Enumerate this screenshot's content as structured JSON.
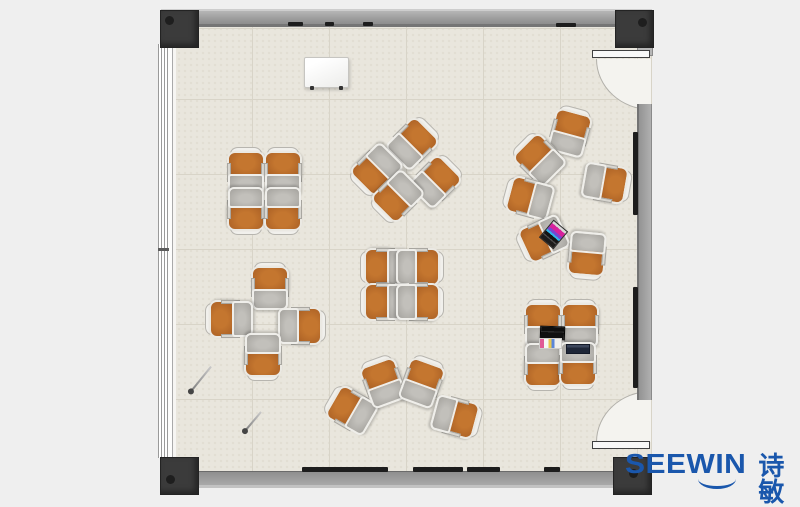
{
  "logo": {
    "brand_en": "SEEWIN",
    "brand_cn": "诗敏",
    "color": "#1a57ac"
  },
  "palette": {
    "page_bg": "#efefef",
    "floor": "#e9e6dd",
    "tile_line": "#d8d4c8",
    "wall": "#9c9c9c",
    "wall_edge": "#757575",
    "post": "#3b3b3b",
    "chair_seat": "#c4762f",
    "chair_seat_edge": "#9d5a22",
    "chair_outline": "#ebe9e3",
    "desk_top": "#b1afaa",
    "desk_outline": "#efeeea",
    "door_sweep": "#f4f3ef",
    "board_strip": "#1d1d1d",
    "window_white": "#fdfdfc",
    "logo_blue": "#1a57ac"
  },
  "room": {
    "wall_boards": [
      {
        "x": 288,
        "y": 22,
        "w": 15,
        "h": 4
      },
      {
        "x": 325,
        "y": 22,
        "w": 9,
        "h": 4
      },
      {
        "x": 363,
        "y": 22,
        "w": 10,
        "h": 4
      },
      {
        "x": 556,
        "y": 23,
        "w": 20,
        "h": 4
      },
      {
        "x": 302,
        "y": 467,
        "w": 86,
        "h": 5
      },
      {
        "x": 413,
        "y": 467,
        "w": 50,
        "h": 5
      },
      {
        "x": 467,
        "y": 467,
        "w": 33,
        "h": 5
      },
      {
        "x": 544,
        "y": 467,
        "w": 16,
        "h": 5
      },
      {
        "x": 633,
        "y": 132,
        "w": 5,
        "h": 83
      },
      {
        "x": 633,
        "y": 287,
        "w": 5,
        "h": 101
      }
    ]
  },
  "furniture": {
    "units": [
      {
        "x": 246,
        "y": 172,
        "rot": 0
      },
      {
        "x": 283,
        "y": 172,
        "rot": 0
      },
      {
        "x": 246,
        "y": 210,
        "rot": 180
      },
      {
        "x": 283,
        "y": 210,
        "rot": 180
      },
      {
        "x": 413,
        "y": 143,
        "rot": 45
      },
      {
        "x": 436,
        "y": 181,
        "rot": 45
      },
      {
        "x": 376,
        "y": 170,
        "rot": 225
      },
      {
        "x": 397,
        "y": 197,
        "rot": 225
      },
      {
        "x": 570,
        "y": 132,
        "rot": 15
      },
      {
        "x": 539,
        "y": 159,
        "rot": 315
      },
      {
        "x": 529,
        "y": 198,
        "rot": 285
      },
      {
        "x": 543,
        "y": 239,
        "rot": 245
      },
      {
        "x": 587,
        "y": 255,
        "rot": 185
      },
      {
        "x": 606,
        "y": 183,
        "rot": 100
      },
      {
        "x": 385,
        "y": 267,
        "rot": 270
      },
      {
        "x": 419,
        "y": 267,
        "rot": 90
      },
      {
        "x": 385,
        "y": 302,
        "rot": 270
      },
      {
        "x": 419,
        "y": 302,
        "rot": 90
      },
      {
        "x": 270,
        "y": 287,
        "rot": 0
      },
      {
        "x": 230,
        "y": 319,
        "rot": 270
      },
      {
        "x": 301,
        "y": 326,
        "rot": 90
      },
      {
        "x": 263,
        "y": 356,
        "rot": 180
      },
      {
        "x": 351,
        "y": 410,
        "rot": 300
      },
      {
        "x": 383,
        "y": 382,
        "rot": 340
      },
      {
        "x": 422,
        "y": 382,
        "rot": 20
      },
      {
        "x": 456,
        "y": 417,
        "rot": 105
      },
      {
        "x": 543,
        "y": 324,
        "rot": 0
      },
      {
        "x": 580,
        "y": 324,
        "rot": 0
      },
      {
        "x": 543,
        "y": 366,
        "rot": 180
      },
      {
        "x": 578,
        "y": 365,
        "rot": 180
      }
    ]
  },
  "objects": {
    "whiteboard": {
      "x": 304,
      "y": 57,
      "w": 43,
      "h": 29
    },
    "desk_items": [
      {
        "cx": 552,
        "cy": 233,
        "w": 17,
        "h": 21,
        "rot": 40,
        "kind": "laptop-colorful"
      },
      {
        "cx": 551,
        "cy": 332,
        "w": 23,
        "h": 12,
        "rot": 2,
        "kind": "laptop-black"
      },
      {
        "cx": 549,
        "cy": 342,
        "w": 21,
        "h": 9,
        "rot": 0,
        "kind": "papers"
      },
      {
        "cx": 577,
        "cy": 348,
        "w": 22,
        "h": 8,
        "rot": 0,
        "kind": "laptop-navy"
      }
    ],
    "pins": [
      {
        "x": 201,
        "y": 379,
        "len": 32,
        "rot": 39
      },
      {
        "x": 253,
        "y": 421,
        "len": 25,
        "rot": 40
      }
    ]
  }
}
